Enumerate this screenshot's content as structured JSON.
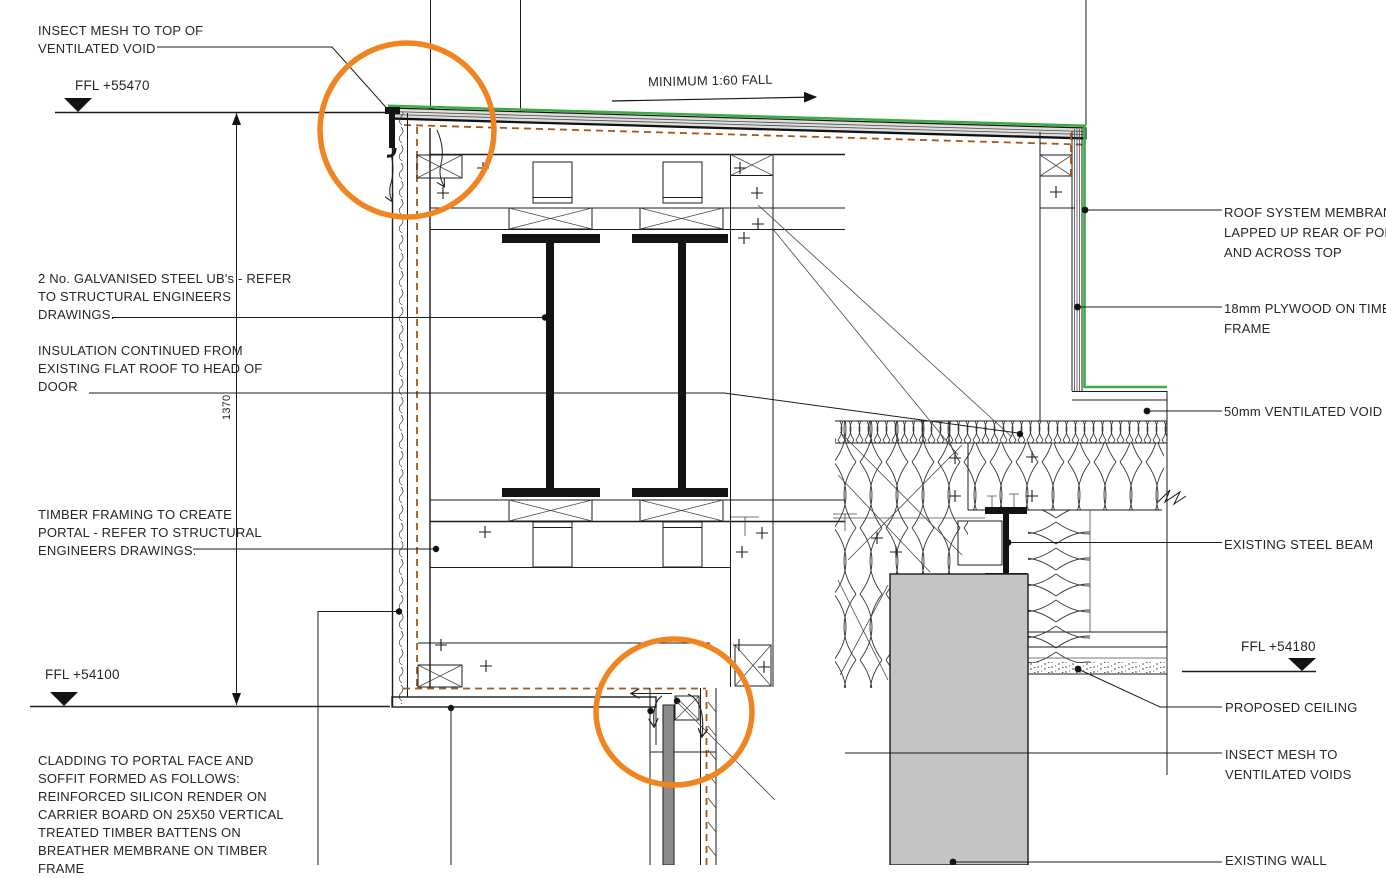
{
  "colors": {
    "highlight": "#f08421",
    "membrane_green": "#3cab42",
    "breather_brown": "#a8551a",
    "wall_gray": "#c4c4c4",
    "door_gray": "#8c8c8c",
    "line": "#1b1b1b"
  },
  "annotations": {
    "insect_mesh_top": "INSECT MESH TO TOP OF\nVENTILATED VOID",
    "ffl_55470": "FFL +55470",
    "minimum_fall": "MINIMUM 1:60 FALL",
    "galvanised_ubs": "2 No. GALVANISED STEEL UB's - REFER\nTO STRUCTURAL ENGINEERS\nDRAWINGS.",
    "insulation_continued": "INSULATION CONTINUED FROM\nEXISTING FLAT ROOF TO HEAD OF\nDOOR",
    "dim_1370": "1370",
    "timber_framing": "TIMBER FRAMING TO CREATE\nPORTAL - REFER TO STRUCTURAL\nENGINEERS DRAWINGS.",
    "ffl_54100": "FFL +54100",
    "cladding": "CLADDING TO PORTAL FACE AND\nSOFFIT FORMED AS FOLLOWS:\nREINFORCED SILICON RENDER ON\nCARRIER BOARD ON 25X50 VERTICAL\nTREATED TIMBER BATTENS ON\nBREATHER MEMBRANE ON TIMBER\nFRAME",
    "roof_membrane": "ROOF SYSTEM MEMBRANE\nLAPPED UP REAR OF PORTAL\nAND ACROSS TOP",
    "plywood": "18mm PLYWOOD ON TIMBER\nFRAME",
    "ventilated_void": "50mm VENTILATED VOID",
    "existing_steel_beam": "EXISTING STEEL BEAM",
    "ffl_54180": "FFL +54180",
    "proposed_ceiling": "PROPOSED CEILING",
    "insect_mesh_voids": "INSECT MESH TO\nVENTILATED VOIDS",
    "existing_wall": "EXISTING WALL"
  }
}
